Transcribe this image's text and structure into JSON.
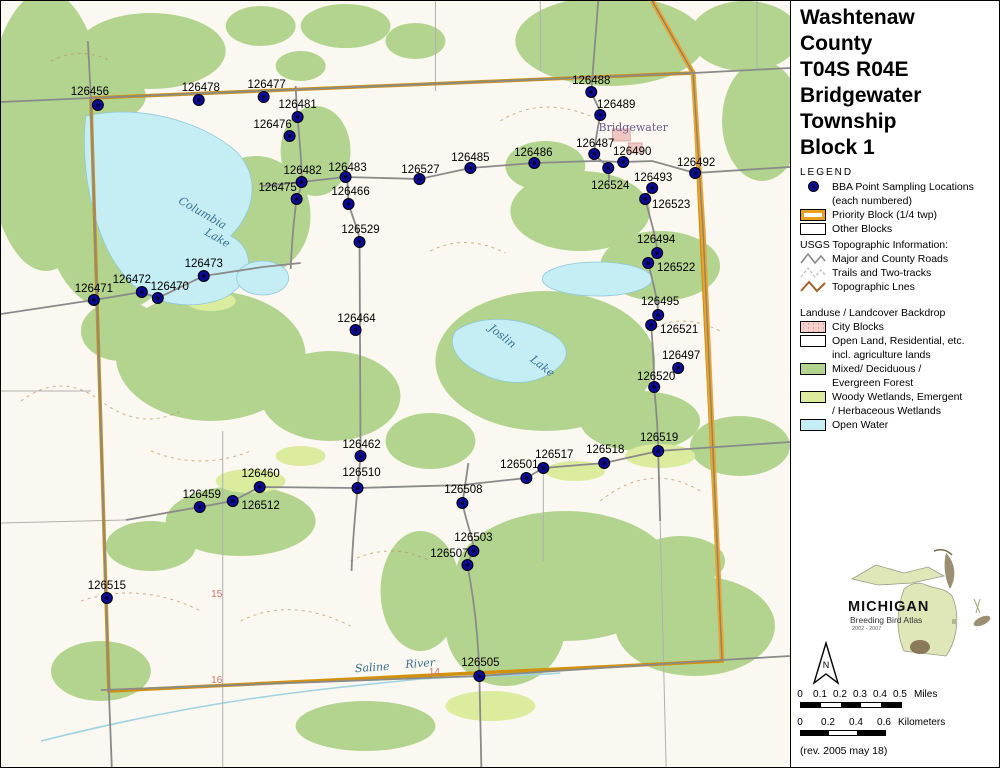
{
  "panel": {
    "title_lines": [
      "Washtenaw",
      "County",
      "T04S R04E",
      "Bridgewater",
      "Township",
      "Block 1"
    ],
    "legend_heading": "LEGEND",
    "legend": {
      "bba_1": "BBA Point Sampling Locations",
      "bba_2": "(each numbered)",
      "priority_block": "Priority Block (1/4 twp)",
      "other_blocks": "Other Blocks",
      "usgs_heading": "USGS Topographic Information:",
      "roads": "Major and County Roads",
      "trails": "Trails and Two-tracks",
      "topo": "Topographic Lnes",
      "landuse_heading": "Landuse / Landcover Backdrop",
      "city_blocks": "City Blocks",
      "open_land_1": "Open Land, Residential, etc.",
      "open_land_2": "incl. agriculture lands",
      "forest_1": "Mixed/ Deciduous /",
      "forest_2": "Evergreen Forest",
      "wetland_1": "Woody Wetlands, Emergent",
      "wetland_2": "/ Herbaceous Wetlands",
      "open_water": "Open Water"
    },
    "logo": {
      "title": "MICHIGAN",
      "subtitle": "Breeding Bird Atlas",
      "years": "2002 - 2007",
      "numeral": "II"
    },
    "north_label": "N",
    "scale": {
      "miles_ticks": [
        "0",
        "0.1",
        "0.2",
        "0.3",
        "0.4",
        "0.5"
      ],
      "miles_unit": "Miles",
      "miles_seg_px": 20,
      "km_ticks": [
        "0",
        "0.2",
        "0.4",
        "0.6"
      ],
      "km_unit": "Kilometers",
      "km_seg_px": 28
    },
    "revision": "(rev. 2005 may 18)"
  },
  "map": {
    "colors": {
      "point": "#0a0a96",
      "priority_block": "#d0920e",
      "forest": "#b3d48e",
      "wetland": "#dcec9f",
      "open_water": "#c5eef4",
      "city_blocks": "#f5d2cd",
      "topo_contour": "#b58a58",
      "road": "#8a8a8a"
    },
    "points": [
      {
        "id": "126456",
        "x": 97,
        "y": 104,
        "lx": 89,
        "ly": 90
      },
      {
        "id": "126478",
        "x": 198,
        "y": 99,
        "lx": 200,
        "ly": 86
      },
      {
        "id": "126477",
        "x": 263,
        "y": 96,
        "lx": 266,
        "ly": 83
      },
      {
        "id": "126481",
        "x": 297,
        "y": 116,
        "lx": 297,
        "ly": 103
      },
      {
        "id": "126476",
        "x": 289,
        "y": 135,
        "lx": 272,
        "ly": 123
      },
      {
        "id": "126482",
        "x": 301,
        "y": 181,
        "lx": 302,
        "ly": 169
      },
      {
        "id": "126483",
        "x": 345,
        "y": 176,
        "lx": 347,
        "ly": 166
      },
      {
        "id": "126527",
        "x": 419,
        "y": 178,
        "lx": 420,
        "ly": 168
      },
      {
        "id": "126485",
        "x": 470,
        "y": 167,
        "lx": 470,
        "ly": 156
      },
      {
        "id": "126486",
        "x": 534,
        "y": 162,
        "lx": 533,
        "ly": 151
      },
      {
        "id": "126488",
        "x": 591,
        "y": 91,
        "lx": 591,
        "ly": 79
      },
      {
        "id": "126489",
        "x": 600,
        "y": 114,
        "lx": 616,
        "ly": 103
      },
      {
        "id": "126487",
        "x": 594,
        "y": 153,
        "lx": 595,
        "ly": 142
      },
      {
        "id": "126490",
        "x": 623,
        "y": 161,
        "lx": 632,
        "ly": 150
      },
      {
        "id": "126524",
        "x": 608,
        "y": 167,
        "lx": 610,
        "ly": 184
      },
      {
        "id": "126492",
        "x": 695,
        "y": 172,
        "lx": 696,
        "ly": 161
      },
      {
        "id": "126493",
        "x": 652,
        "y": 187,
        "lx": 653,
        "ly": 176
      },
      {
        "id": "126523",
        "x": 645,
        "y": 198,
        "lx": 671,
        "ly": 203
      },
      {
        "id": "126494",
        "x": 657,
        "y": 252,
        "lx": 656,
        "ly": 238
      },
      {
        "id": "126522",
        "x": 648,
        "y": 262,
        "lx": 676,
        "ly": 266
      },
      {
        "id": "126495",
        "x": 658,
        "y": 314,
        "lx": 660,
        "ly": 300
      },
      {
        "id": "126521",
        "x": 651,
        "y": 324,
        "lx": 679,
        "ly": 328
      },
      {
        "id": "126497",
        "x": 678,
        "y": 367,
        "lx": 681,
        "ly": 354
      },
      {
        "id": "126520",
        "x": 654,
        "y": 386,
        "lx": 656,
        "ly": 375
      },
      {
        "id": "126473",
        "x": 203,
        "y": 275,
        "lx": 203,
        "ly": 262
      },
      {
        "id": "126471",
        "x": 93,
        "y": 299,
        "lx": 93,
        "ly": 287
      },
      {
        "id": "126472",
        "x": 141,
        "y": 291,
        "lx": 131,
        "ly": 278
      },
      {
        "id": "126470",
        "x": 157,
        "y": 297,
        "lx": 169,
        "ly": 285
      },
      {
        "id": "126464",
        "x": 355,
        "y": 329,
        "lx": 356,
        "ly": 317
      },
      {
        "id": "126529",
        "x": 359,
        "y": 241,
        "lx": 360,
        "ly": 228
      },
      {
        "id": "126466",
        "x": 348,
        "y": 203,
        "lx": 350,
        "ly": 190
      },
      {
        "id": "126475",
        "x": 296,
        "y": 198,
        "lx": 277,
        "ly": 186
      },
      {
        "id": "126462",
        "x": 360,
        "y": 455,
        "lx": 361,
        "ly": 443
      },
      {
        "id": "126460",
        "x": 259,
        "y": 486,
        "lx": 260,
        "ly": 472
      },
      {
        "id": "126510",
        "x": 357,
        "y": 487,
        "lx": 361,
        "ly": 471
      },
      {
        "id": "126459",
        "x": 199,
        "y": 506,
        "lx": 201,
        "ly": 493
      },
      {
        "id": "126512",
        "x": 232,
        "y": 500,
        "lx": 260,
        "ly": 504
      },
      {
        "id": "126501",
        "x": 526,
        "y": 477,
        "lx": 519,
        "ly": 463
      },
      {
        "id": "126517",
        "x": 543,
        "y": 467,
        "lx": 554,
        "ly": 453
      },
      {
        "id": "126518",
        "x": 604,
        "y": 462,
        "lx": 605,
        "ly": 448
      },
      {
        "id": "126519",
        "x": 658,
        "y": 450,
        "lx": 659,
        "ly": 436
      },
      {
        "id": "126508",
        "x": 462,
        "y": 502,
        "lx": 463,
        "ly": 488
      },
      {
        "id": "126503",
        "x": 473,
        "y": 550,
        "lx": 473,
        "ly": 536
      },
      {
        "id": "126507",
        "x": 467,
        "y": 564,
        "lx": 449,
        "ly": 552
      },
      {
        "id": "126515",
        "x": 106,
        "y": 597,
        "lx": 106,
        "ly": 584
      },
      {
        "id": "126505",
        "x": 479,
        "y": 675,
        "lx": 480,
        "ly": 661
      }
    ],
    "place_labels": [
      {
        "text": "Columbia",
        "x": 200,
        "y": 215,
        "rot": 30,
        "cls": "water-label"
      },
      {
        "text": "Lake",
        "x": 215,
        "y": 240,
        "rot": 30,
        "cls": "water-label"
      },
      {
        "text": "Joslin",
        "x": 500,
        "y": 338,
        "rot": 38,
        "cls": "water-label"
      },
      {
        "text": "Lake",
        "x": 540,
        "y": 368,
        "rot": 38,
        "cls": "water-label"
      },
      {
        "text": "Bridgewater",
        "x": 633,
        "y": 130,
        "rot": 0,
        "cls": "town-label"
      },
      {
        "text": "Saline",
        "x": 372,
        "y": 670,
        "rot": -4,
        "cls": "water-label"
      },
      {
        "text": "River",
        "x": 420,
        "y": 666,
        "rot": -4,
        "cls": "water-label"
      },
      {
        "text": "15",
        "x": 216,
        "y": 596,
        "rot": 0,
        "cls": "section-label"
      },
      {
        "text": "16",
        "x": 216,
        "y": 682,
        "rot": 0,
        "cls": "section-label"
      },
      {
        "text": "14",
        "x": 434,
        "y": 674,
        "rot": 0,
        "cls": "section-label"
      }
    ]
  }
}
